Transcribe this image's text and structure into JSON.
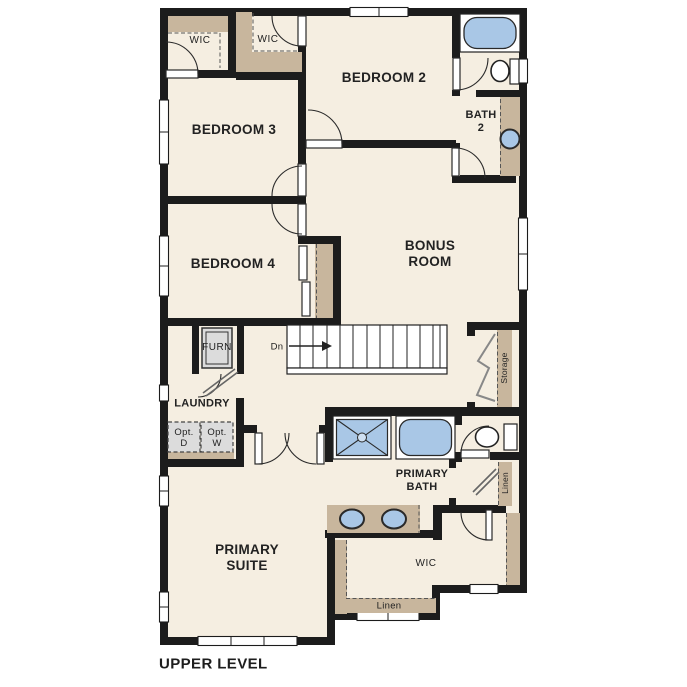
{
  "plan": {
    "title": "UPPER LEVEL",
    "labels": {
      "wic_top_left": "WIC",
      "wic_top_mid": "WIC",
      "bedroom_2": "BEDROOM 2",
      "bath_2": "BATH\n2",
      "bedroom_3": "BEDROOM 3",
      "bedroom_4": "BEDROOM 4",
      "bonus_room": "BONUS\nROOM",
      "stairs_dn": "Dn",
      "furnace": "FURN",
      "laundry": "LAUNDRY",
      "opt_dryer": "Opt.\nD",
      "opt_washer": "Opt.\nW",
      "storage": "Storage",
      "primary_bath": "PRIMARY\nBATH",
      "linen_hall": "Linen",
      "primary_suite": "PRIMARY\nSUITE",
      "wic_primary": "WIC",
      "linen_closet": "Linen"
    },
    "colors": {
      "wall": "#1c1c1c",
      "floor": "#f5eee1",
      "shelf_tan": "#c8b69d",
      "fixture_blue": "#a9c7e6",
      "appliance_gray": "#dcdcdc",
      "background": "#ffffff"
    }
  }
}
